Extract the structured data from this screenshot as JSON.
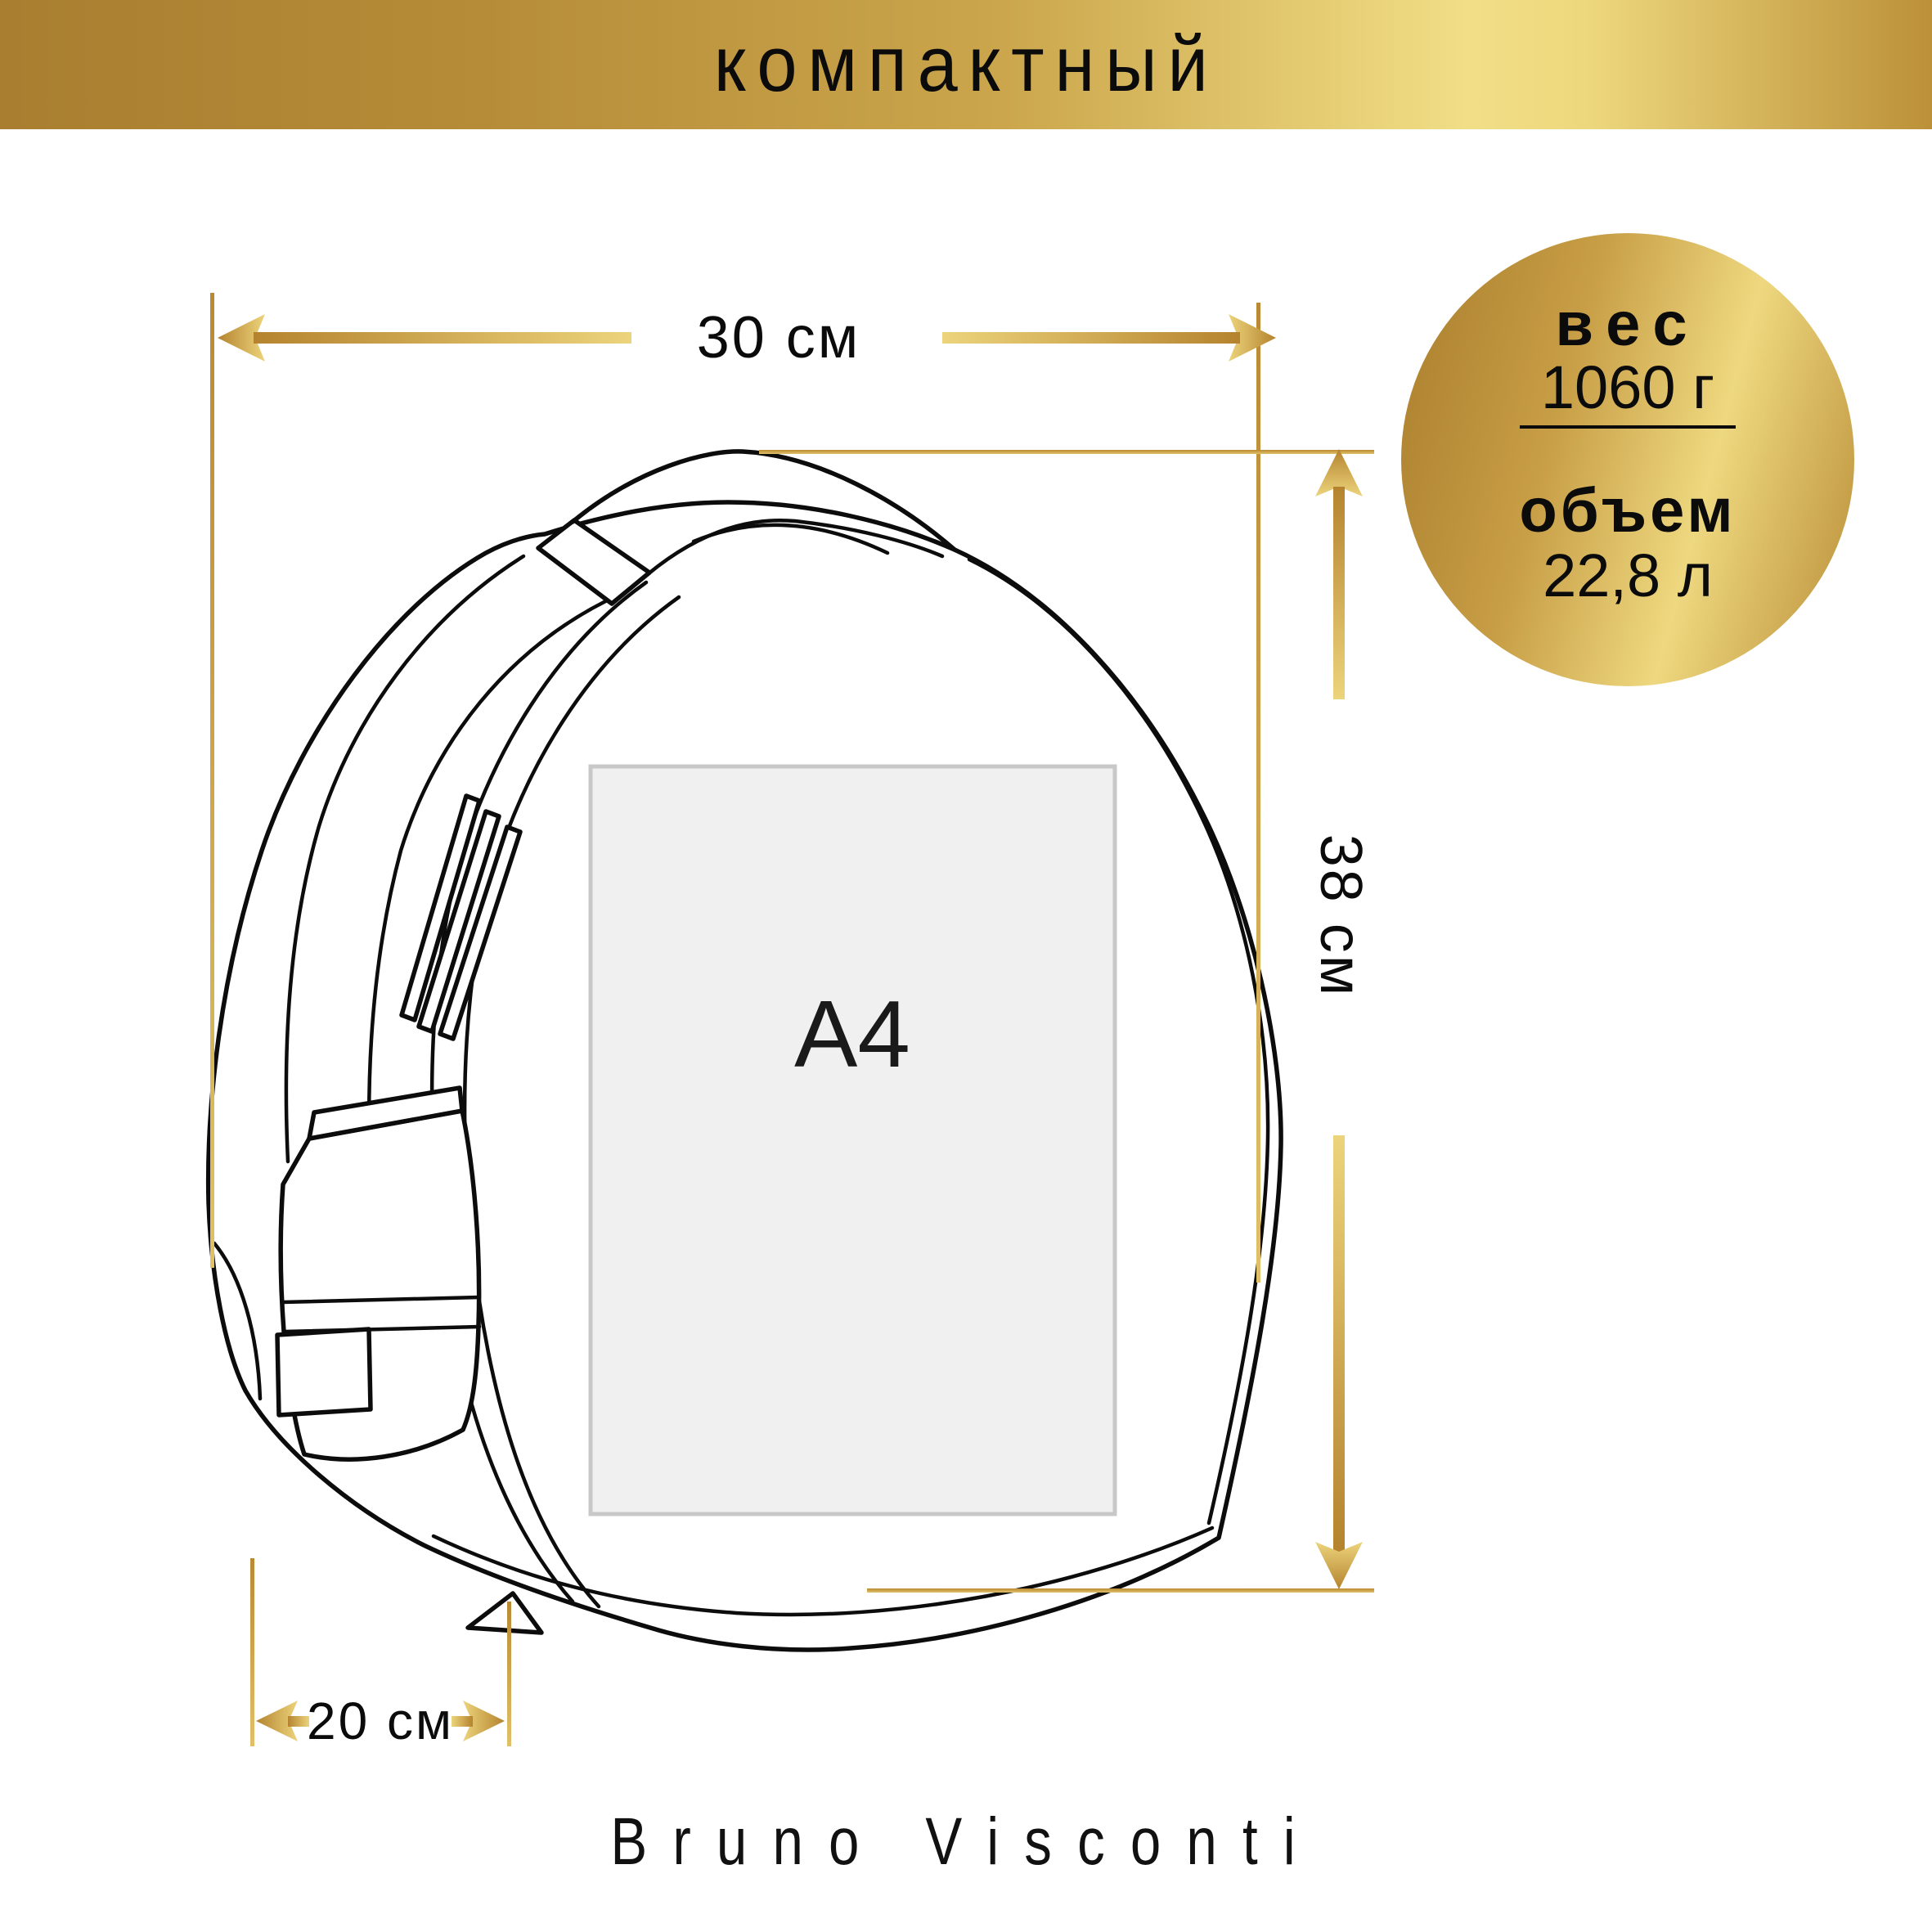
{
  "banner": {
    "label": "компактный"
  },
  "badge": {
    "weight_label": "вес",
    "weight_value": "1060 г",
    "volume_label": "объем",
    "volume_value": "22,8 л"
  },
  "dimensions": {
    "width": "30 см",
    "height": "38 см",
    "depth": "20 см"
  },
  "paper": {
    "label": "A4"
  },
  "brand": {
    "label": "Bruno Visconti"
  },
  "colors": {
    "gold_dark": "#b5832e",
    "gold_light": "#ecd47c",
    "gold_line": "#c79d43",
    "banner_light": "#f1de86",
    "outline": "#0c0c0c",
    "paper_fill": "#f0f0f0",
    "paper_border": "#c8c8c8"
  }
}
